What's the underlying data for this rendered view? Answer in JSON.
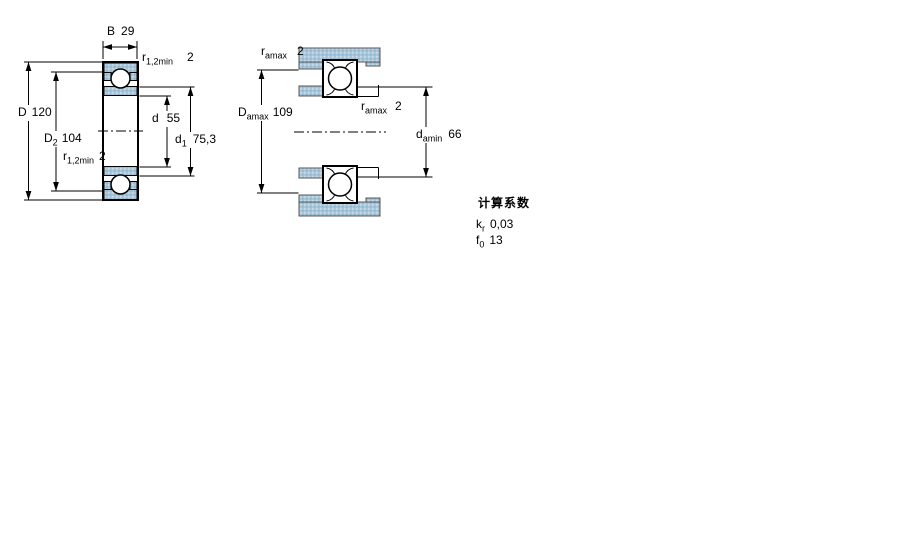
{
  "left_view": {
    "labels": {
      "b": {
        "base": "B",
        "sub": "",
        "value": "29"
      },
      "r_top": {
        "base": "r",
        "sub": "1,2min",
        "value": "2"
      },
      "D": {
        "base": "D",
        "sub": "",
        "value": "120"
      },
      "D2": {
        "base": "D",
        "sub": "2",
        "value": "104"
      },
      "d": {
        "base": "d",
        "sub": "",
        "value": "55"
      },
      "d1": {
        "base": "d",
        "sub": "1",
        "value": "75,3"
      },
      "r_bottom": {
        "base": "r",
        "sub": "1,2min",
        "value": "2"
      }
    }
  },
  "right_view": {
    "labels": {
      "ramax_top": {
        "base": "r",
        "sub": "amax",
        "value": "2"
      },
      "Damax": {
        "base": "D",
        "sub": "amax",
        "value": "109"
      },
      "ramax_mid": {
        "base": "r",
        "sub": "amax",
        "value": "2"
      },
      "damin": {
        "base": "d",
        "sub": "amin",
        "value": "66"
      }
    }
  },
  "calculation_factors": {
    "heading": "计算系数",
    "rows": [
      {
        "base": "k",
        "sub": "r",
        "value": "0,03"
      },
      {
        "base": "f",
        "sub": "0",
        "value": "13"
      }
    ]
  },
  "colors": {
    "hatch_fill": "#a9c7db",
    "hatch_dot_light": "#c9dcea",
    "hatch_dot_dark": "#8fb2c9",
    "line": "#000000"
  }
}
